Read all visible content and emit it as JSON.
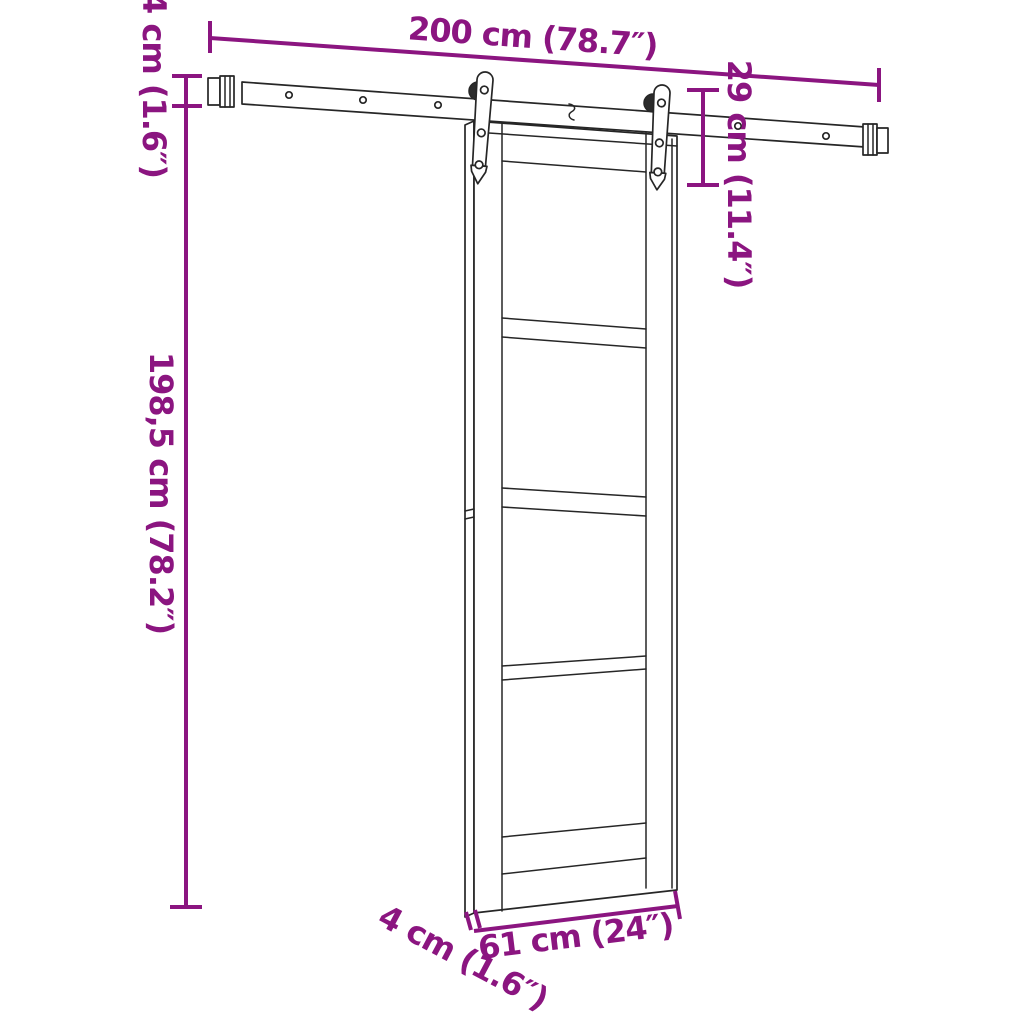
{
  "diagram": {
    "kind": "sliding-barn-door-with-rail-hardware-dimension-diagram",
    "background": "#ffffff",
    "accent_color": "#8B1580",
    "line_color": "#262626"
  },
  "dimensions": {
    "rail_length": "200 cm (78.7″)",
    "rail_profile_height": "4 cm (1.6″)",
    "hanger_drop": "29 cm (11.4″)",
    "door_height": "198,5 cm (78.2″)",
    "door_width": "61 cm (24″)",
    "door_thickness": "4 cm (1.6″)"
  }
}
